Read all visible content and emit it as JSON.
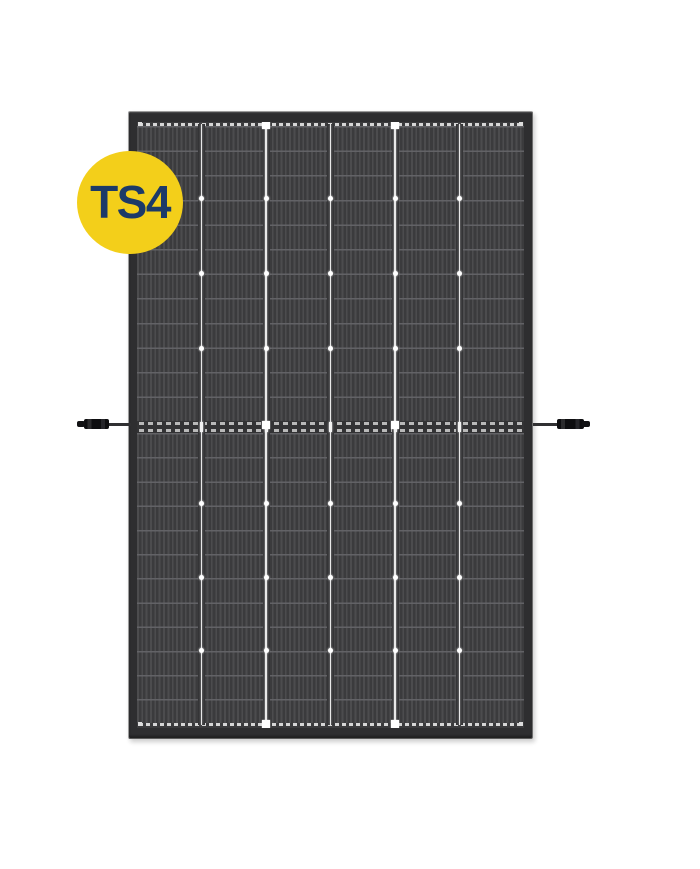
{
  "page": {
    "background_color": "#FFFFFF"
  },
  "badge": {
    "label": "TS4",
    "bg_color": "#F3CF1A",
    "text_color": "#1C3A68"
  },
  "panel": {
    "columns": 6,
    "rows_per_half": 12,
    "halves": 2,
    "frame_color": "#2E2E30",
    "cell_color": "#3B3B3D",
    "finger_color": "#4C4C4E",
    "grid_line_color": "#E8E8E8",
    "busbar_dash_color": "#D6D6D6",
    "connector_left": "mc4-cable-connector",
    "connector_right": "mc4-cable-connector"
  }
}
